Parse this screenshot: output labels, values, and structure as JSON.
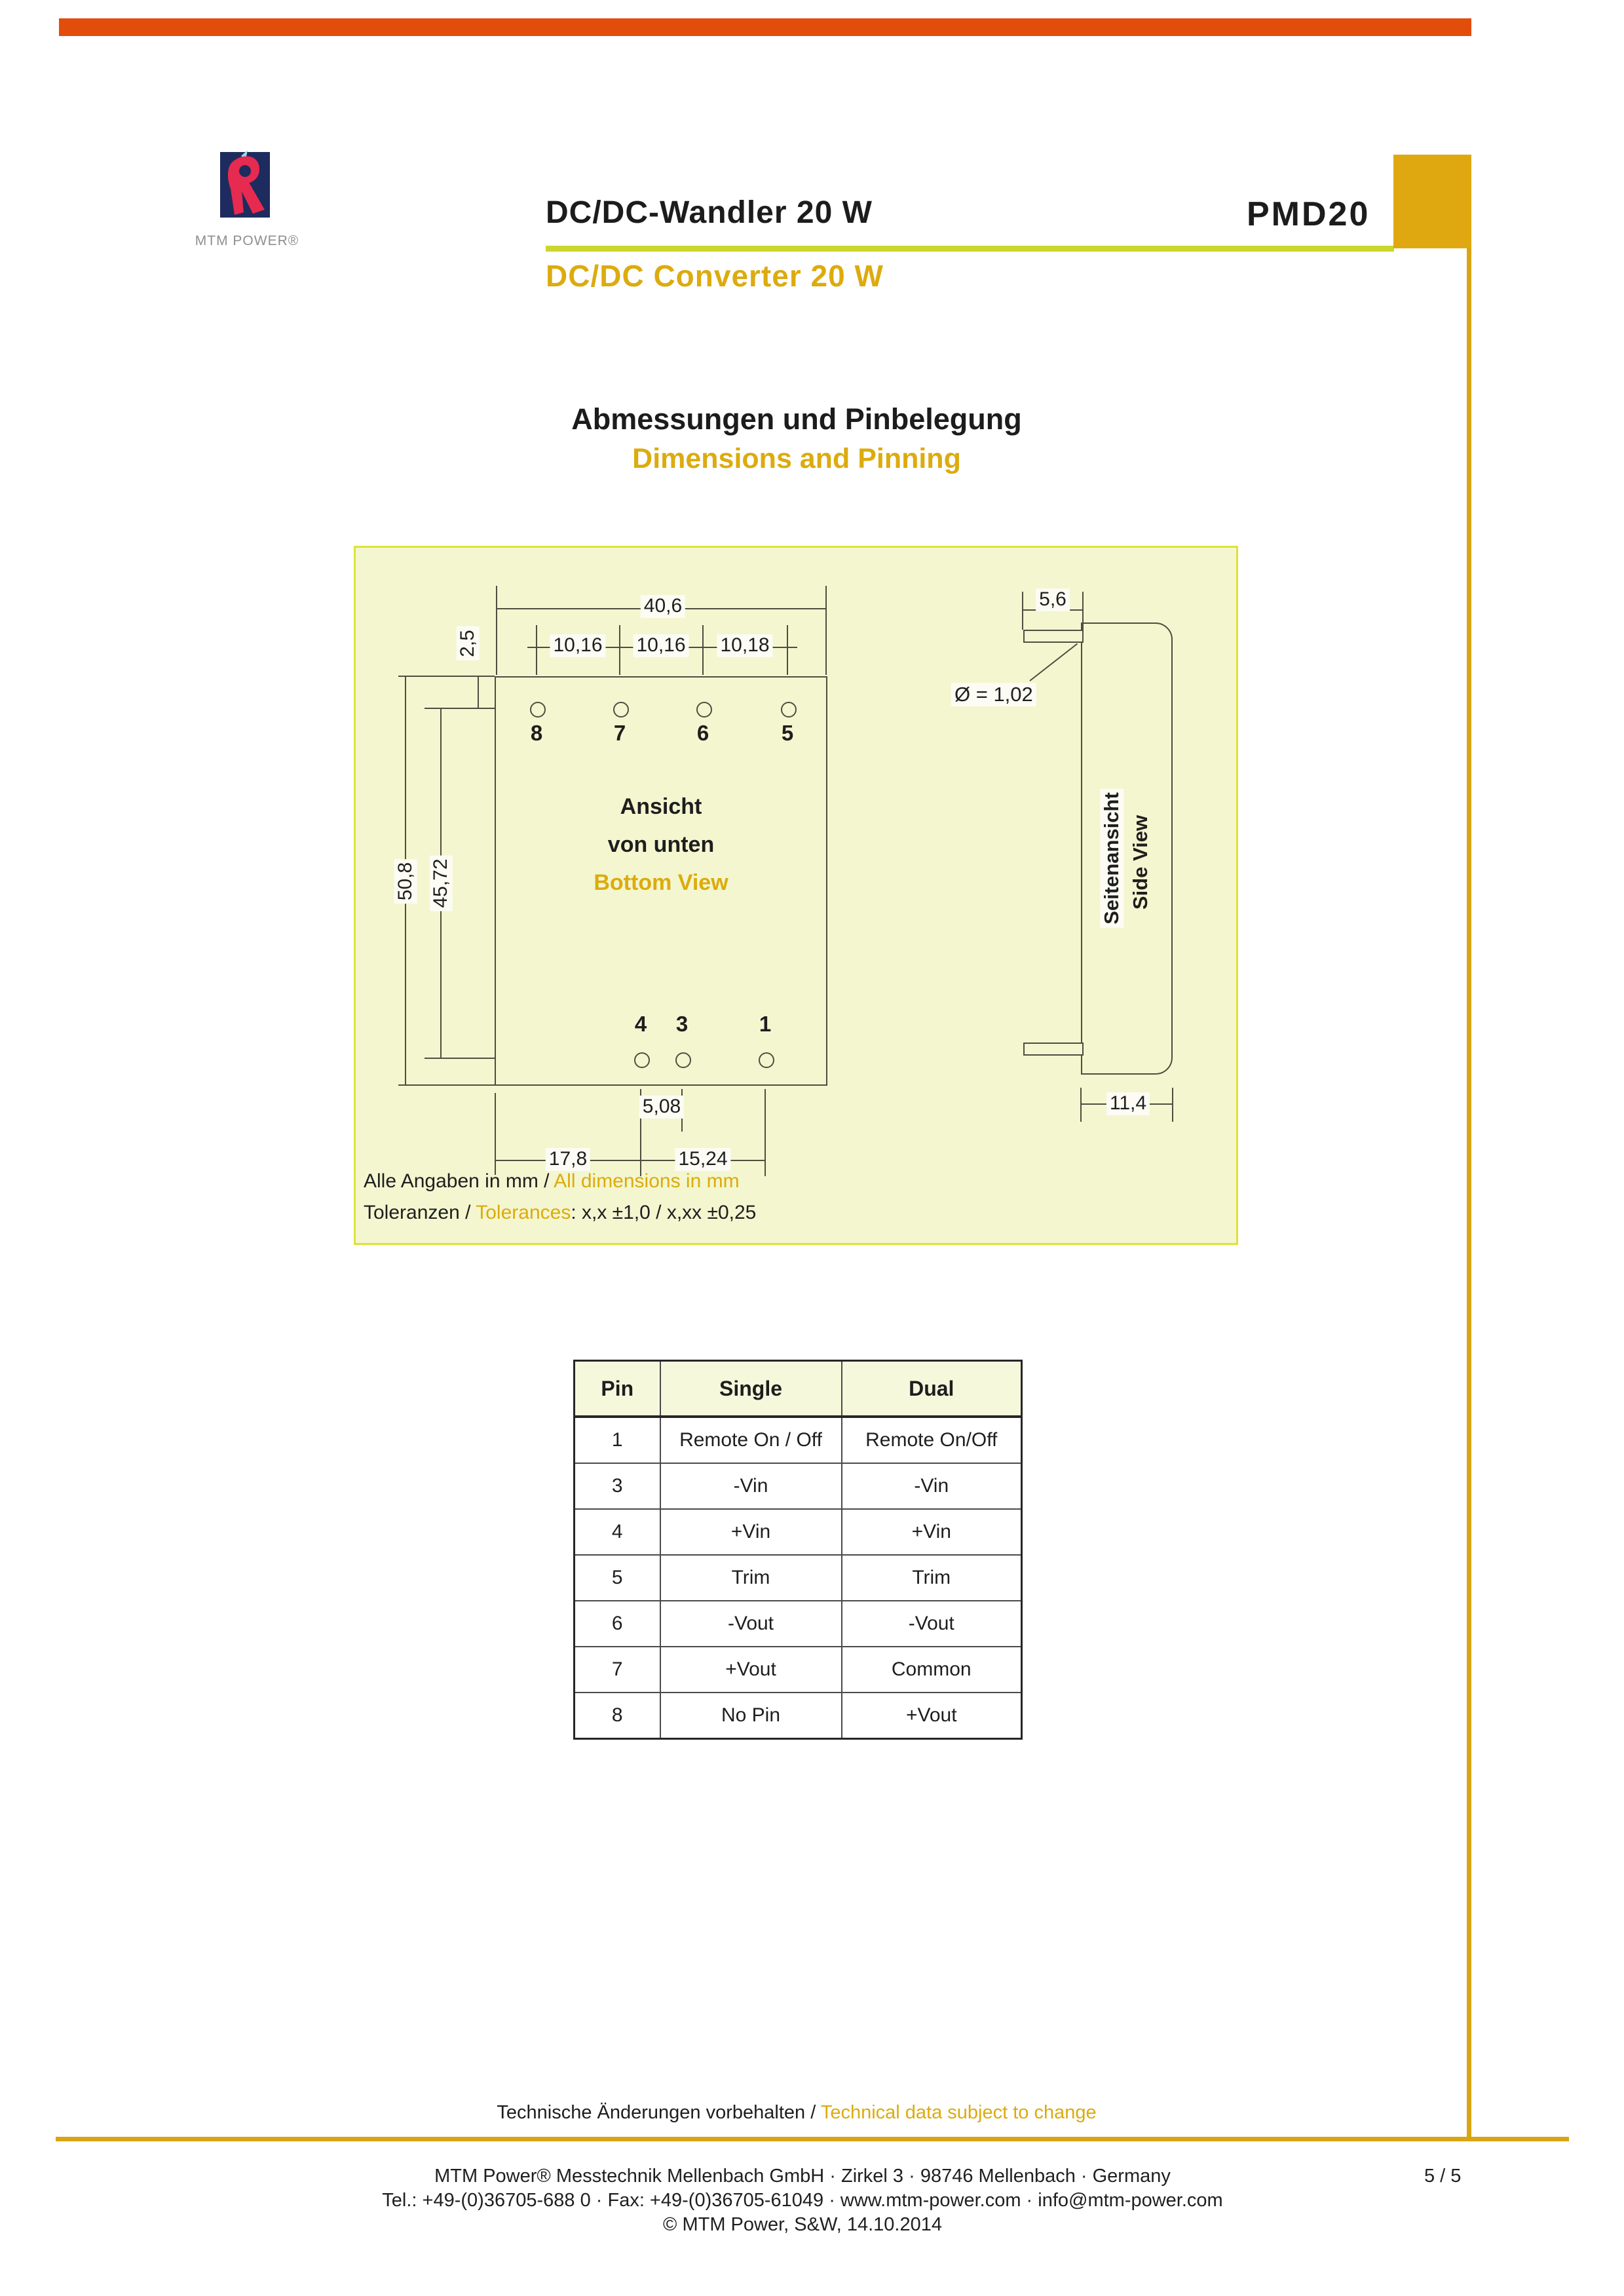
{
  "colors": {
    "top_bar": "#e34d0c",
    "gold_text": "#dcab0e",
    "gold_bar": "#d9a513",
    "gold_box": "#e0a810",
    "lime_underline": "#cbd62e",
    "panel_bg": "#f3f6cf",
    "brand_red": "#e72a50",
    "brand_navy": "#1d2b5e"
  },
  "header": {
    "brand": "MTM POWER®",
    "title_de": "DC/DC-Wandler 20 W",
    "title_en": "DC/DC Converter 20 W",
    "product": "PMD20"
  },
  "heading": {
    "de": "Abmessungen und Pinbelegung",
    "en": "Dimensions and Pinning"
  },
  "diagram": {
    "bottom_view": {
      "label_line1": "Ansicht",
      "label_line2": "von unten",
      "label_en": "Bottom View",
      "top_pins": [
        "8",
        "7",
        "6",
        "5"
      ],
      "bottom_pins": [
        "4",
        "3",
        "1"
      ],
      "dims": {
        "total_width": "40,6",
        "pitch_1": "10,16",
        "pitch_2": "10,16",
        "pitch_3": "10,18",
        "edge_offset": "2,5",
        "total_height": "50,8",
        "pin_row_span": "45,72",
        "pin_gap": "5,08",
        "left_offset": "17,8",
        "right_span": "15,24"
      }
    },
    "side_view": {
      "label_de": "Seitenansicht",
      "label_en": "Side View",
      "dims": {
        "pin_length": "5,6",
        "pin_diameter": "Ø = 1,02",
        "body_depth": "11,4"
      }
    },
    "notes": {
      "units_de": "Alle Angaben in mm / ",
      "units_en": "All dimensions in mm",
      "tol_de": "Toleranzen / ",
      "tol_en": "Tolerances",
      "tol_values": ": x,x ±1,0 / x,xx ±0,25"
    }
  },
  "pin_table": {
    "headers": [
      "Pin",
      "Single",
      "Dual"
    ],
    "rows": [
      [
        "1",
        "Remote On / Off",
        "Remote On/Off"
      ],
      [
        "3",
        "-Vin",
        "-Vin"
      ],
      [
        "4",
        "+Vin",
        "+Vin"
      ],
      [
        "5",
        "Trim",
        "Trim"
      ],
      [
        "6",
        "-Vout",
        "-Vout"
      ],
      [
        "7",
        "+Vout",
        "Common"
      ],
      [
        "8",
        "No Pin",
        "+Vout"
      ]
    ]
  },
  "footer": {
    "change_de": "Technische Änderungen vorbehalten / ",
    "change_en": "Technical data subject to change",
    "line1": "MTM Power®  Messtechnik Mellenbach GmbH · Zirkel 3 · 98746 Mellenbach · Germany",
    "line2": "Tel.: +49-(0)36705-688 0 · Fax: +49-(0)36705-61049 · www.mtm-power.com · info@mtm-power.com",
    "line3": "© MTM Power, S&W, 14.10.2014",
    "page_number": "5 / 5"
  }
}
